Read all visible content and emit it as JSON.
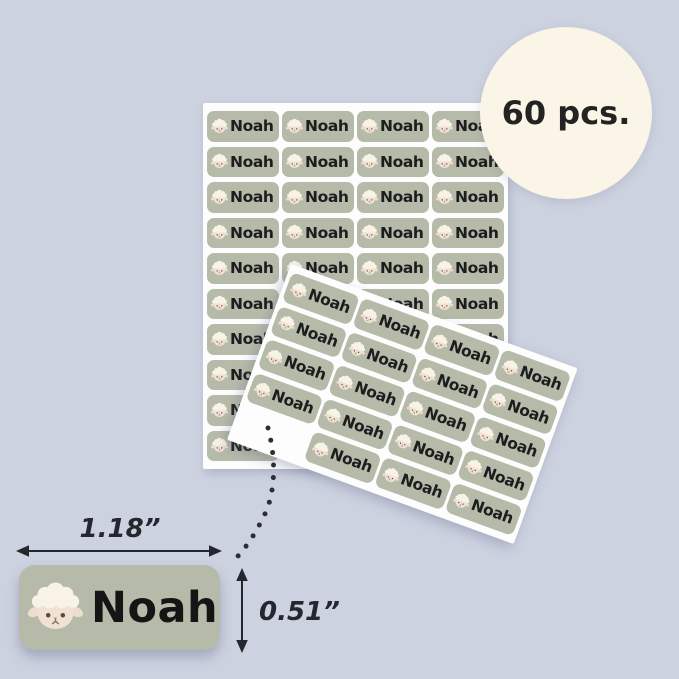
{
  "badge": {
    "label": "60 pcs."
  },
  "label": {
    "name": "Noah",
    "icon": "sheep-icon"
  },
  "sheets": {
    "back": {
      "rows": 10,
      "cols": 4,
      "rotation_deg": 0
    },
    "front": {
      "rows": 5,
      "cols": 4,
      "rotation_deg": 20,
      "missing_slot": {
        "row": 5,
        "col": 1
      }
    }
  },
  "sample": {
    "name": "Noah",
    "width_label": "1.18”",
    "height_label": "0.51”"
  },
  "colors": {
    "background": "#cdd2e0",
    "sheet": "#fdfdfe",
    "label_bg": "#b6bba9",
    "label_text": "#1d1d1f",
    "badge_bg": "#faf5e6",
    "badge_text": "#232323",
    "annotation": "#25272e",
    "sheep_wool": "#f8f3e6",
    "sheep_face": "#f0e1d2"
  }
}
